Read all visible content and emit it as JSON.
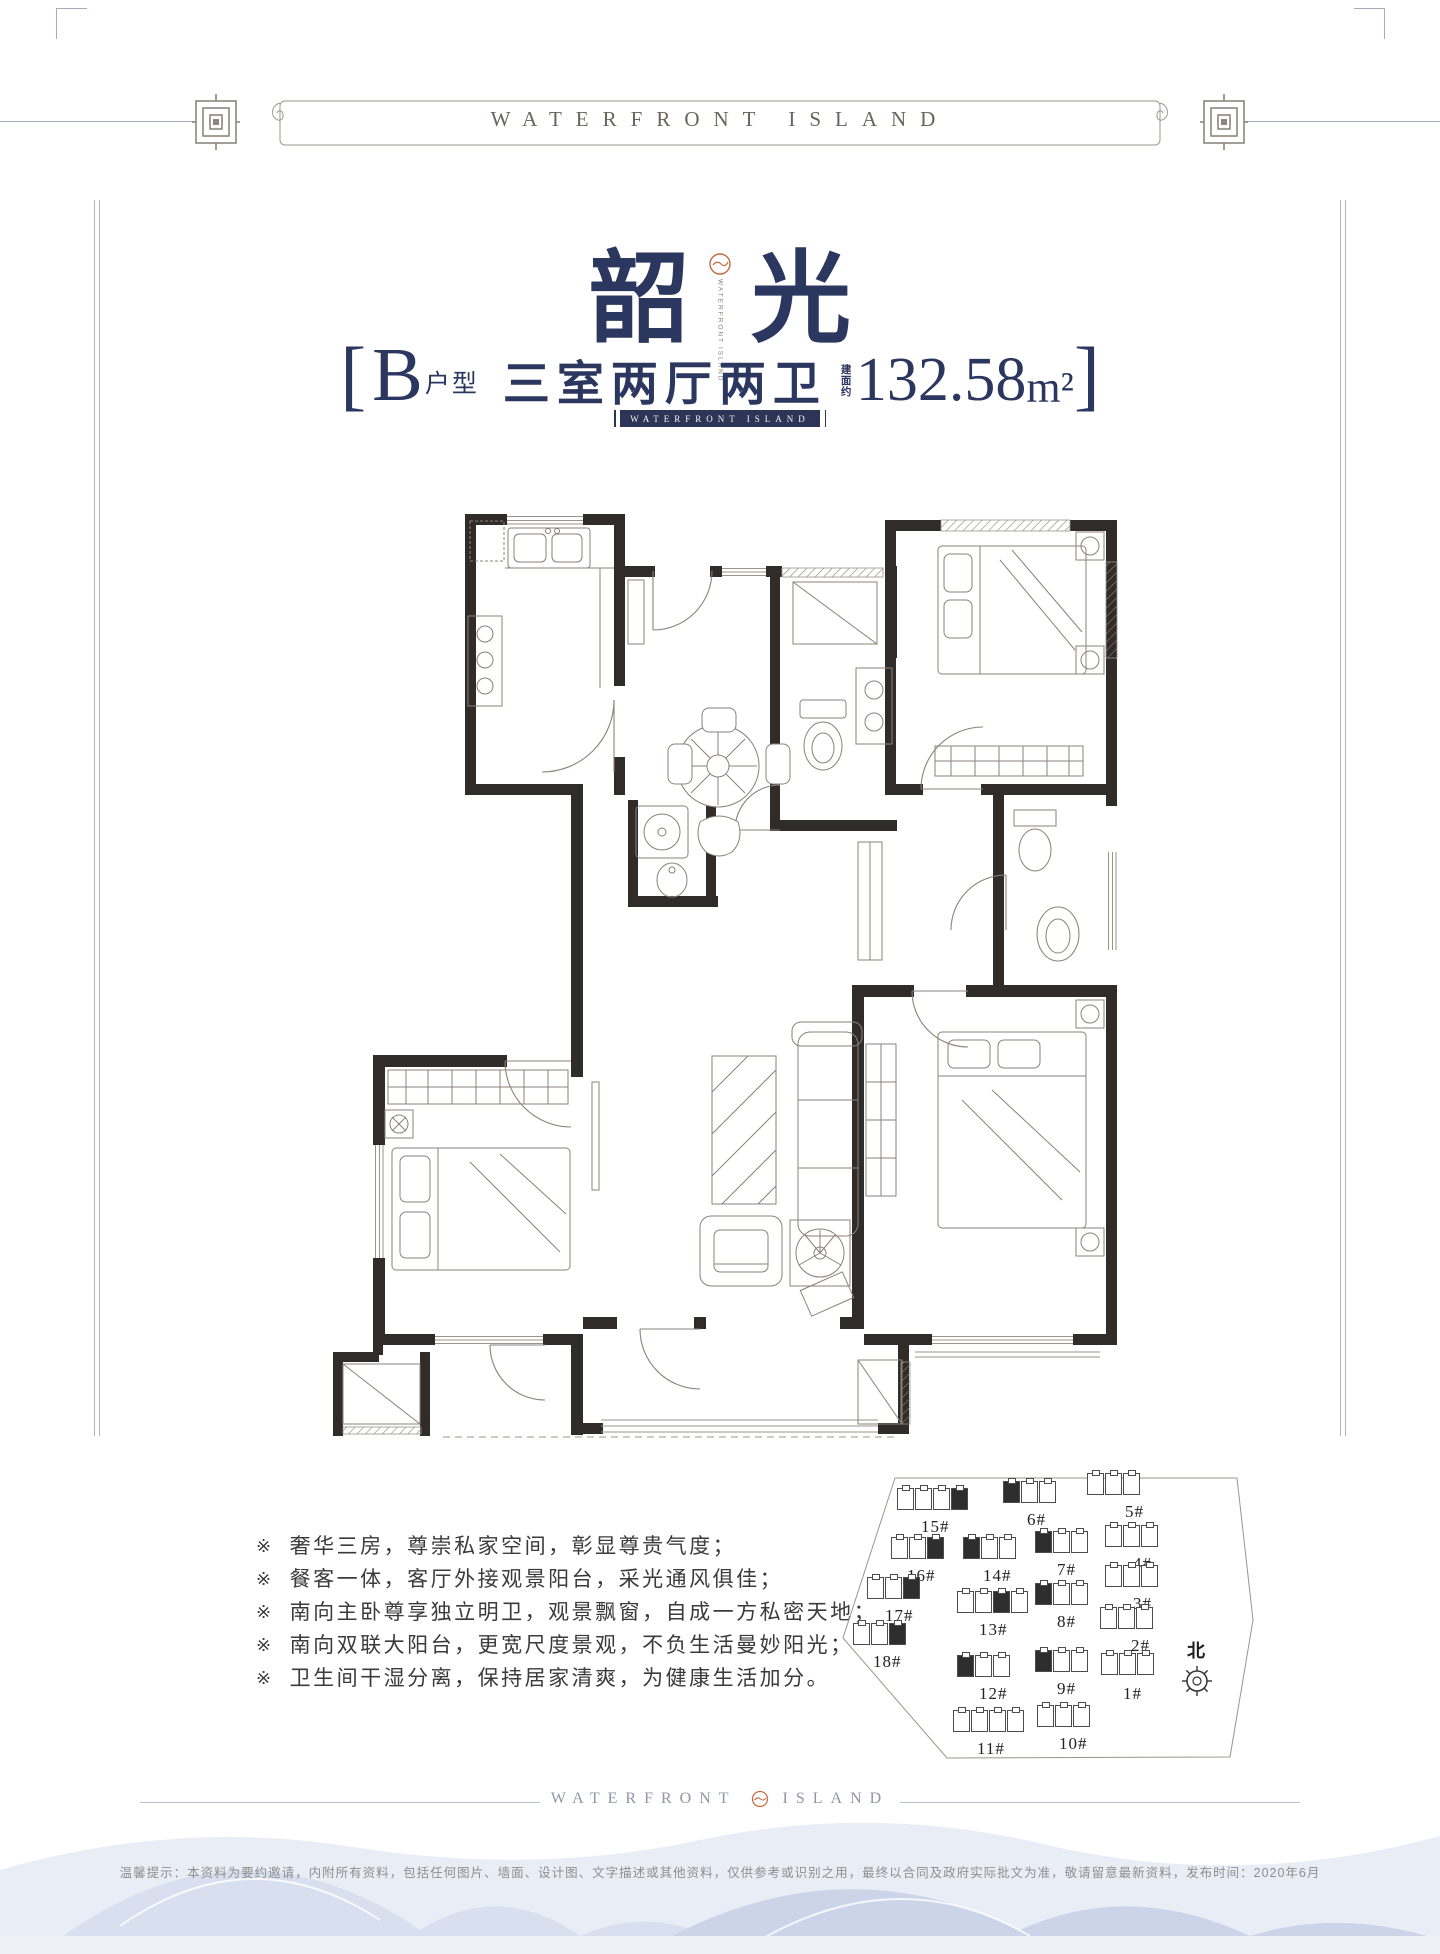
{
  "colors": {
    "navy": "#2c3760",
    "ribbon_navy": "#2c3457",
    "orange": "#c4683f",
    "wall": "#302c29",
    "plan_line": "#8b8177",
    "frame_line": "#a5adbb",
    "mountain_back": "#e9edf6",
    "mountain_mid": "#d8dfee",
    "mountain_front": "#cbd4e8"
  },
  "banner": {
    "title": "WATERFRONT ISLAND"
  },
  "header": {
    "title_left": "韶",
    "title_right": "光",
    "logo": {
      "line1": "WATERFRONT",
      "line2": "ISLAND"
    },
    "subtitle": {
      "bracket_open": "[",
      "unit_letter": "B",
      "unit_word": "户型",
      "rooms": "三室两厅两卫",
      "area_label": "建面约",
      "area_value": "132.58",
      "area_unit": "m²",
      "bracket_close": "]"
    },
    "ribbon": "WATERFRONT ISLAND"
  },
  "features": {
    "marker": "※",
    "items": [
      "奢华三房，尊崇私家空间，彰显尊贵气度；",
      "餐客一体，客厅外接观景阳台，采光通风俱佳；",
      "南向主卧尊享独立明卫，观景飘窗，自成一方私密天地；",
      "南向双联大阳台，更宽尺度景观，不负生活曼妙阳光；",
      "卫生间干湿分离，保持居家清爽，为健康生活加分。"
    ]
  },
  "site_map": {
    "north_label": "北",
    "buildings": [
      {
        "label": "15#",
        "ix": 62,
        "iy": 33,
        "lx": 86,
        "ly": 62,
        "units": 4,
        "dark": "right"
      },
      {
        "label": "6#",
        "ix": 168,
        "iy": 26,
        "lx": 192,
        "ly": 55,
        "units": 3,
        "dark": "left"
      },
      {
        "label": "5#",
        "ix": 252,
        "iy": 18,
        "lx": 290,
        "ly": 47,
        "units": 3,
        "dark": "none"
      },
      {
        "label": "16#",
        "ix": 56,
        "iy": 82,
        "lx": 72,
        "ly": 111,
        "units": 3,
        "dark": "right"
      },
      {
        "label": "14#",
        "ix": 128,
        "iy": 82,
        "lx": 148,
        "ly": 111,
        "units": 3,
        "dark": "left"
      },
      {
        "label": "7#",
        "ix": 200,
        "iy": 76,
        "lx": 222,
        "ly": 105,
        "units": 3,
        "dark": "left"
      },
      {
        "label": "4#",
        "ix": 270,
        "iy": 70,
        "lx": 298,
        "ly": 99,
        "units": 3,
        "dark": "none"
      },
      {
        "label": "17#",
        "ix": 32,
        "iy": 122,
        "lx": 50,
        "ly": 151,
        "units": 3,
        "dark": "right"
      },
      {
        "label": "3#",
        "ix": 270,
        "iy": 110,
        "lx": 298,
        "ly": 139,
        "units": 3,
        "dark": "none"
      },
      {
        "label": "18#",
        "ix": 18,
        "iy": 168,
        "lx": 38,
        "ly": 197,
        "units": 3,
        "dark": "right"
      },
      {
        "label": "13#",
        "ix": 122,
        "iy": 136,
        "lx": 144,
        "ly": 165,
        "units": 4,
        "dark": "mid"
      },
      {
        "label": "8#",
        "ix": 200,
        "iy": 128,
        "lx": 222,
        "ly": 157,
        "units": 3,
        "dark": "left"
      },
      {
        "label": "2#",
        "ix": 265,
        "iy": 152,
        "lx": 296,
        "ly": 181,
        "units": 3,
        "dark": "none"
      },
      {
        "label": "12#",
        "ix": 122,
        "iy": 200,
        "lx": 144,
        "ly": 229,
        "units": 3,
        "dark": "left"
      },
      {
        "label": "9#",
        "ix": 200,
        "iy": 195,
        "lx": 222,
        "ly": 224,
        "units": 3,
        "dark": "left"
      },
      {
        "label": "1#",
        "ix": 266,
        "iy": 198,
        "lx": 288,
        "ly": 229,
        "units": 3,
        "dark": "none"
      },
      {
        "label": "11#",
        "ix": 118,
        "iy": 255,
        "lx": 142,
        "ly": 284,
        "units": 4,
        "dark": "none"
      },
      {
        "label": "10#",
        "ix": 202,
        "iy": 250,
        "lx": 224,
        "ly": 279,
        "units": 3,
        "dark": "none"
      }
    ]
  },
  "footer": {
    "brand_left": "WATERFRONT",
    "brand_right": "ISLAND",
    "disclaimer": "温馨提示：本资料为要约邀请，内附所有资料，包括任何图片、墙面、设计图、文字描述或其他资料，仅供参考或识别之用，最终以合同及政府实际批文为准，敬请留意最新资料，发布时间：2020年6月"
  }
}
